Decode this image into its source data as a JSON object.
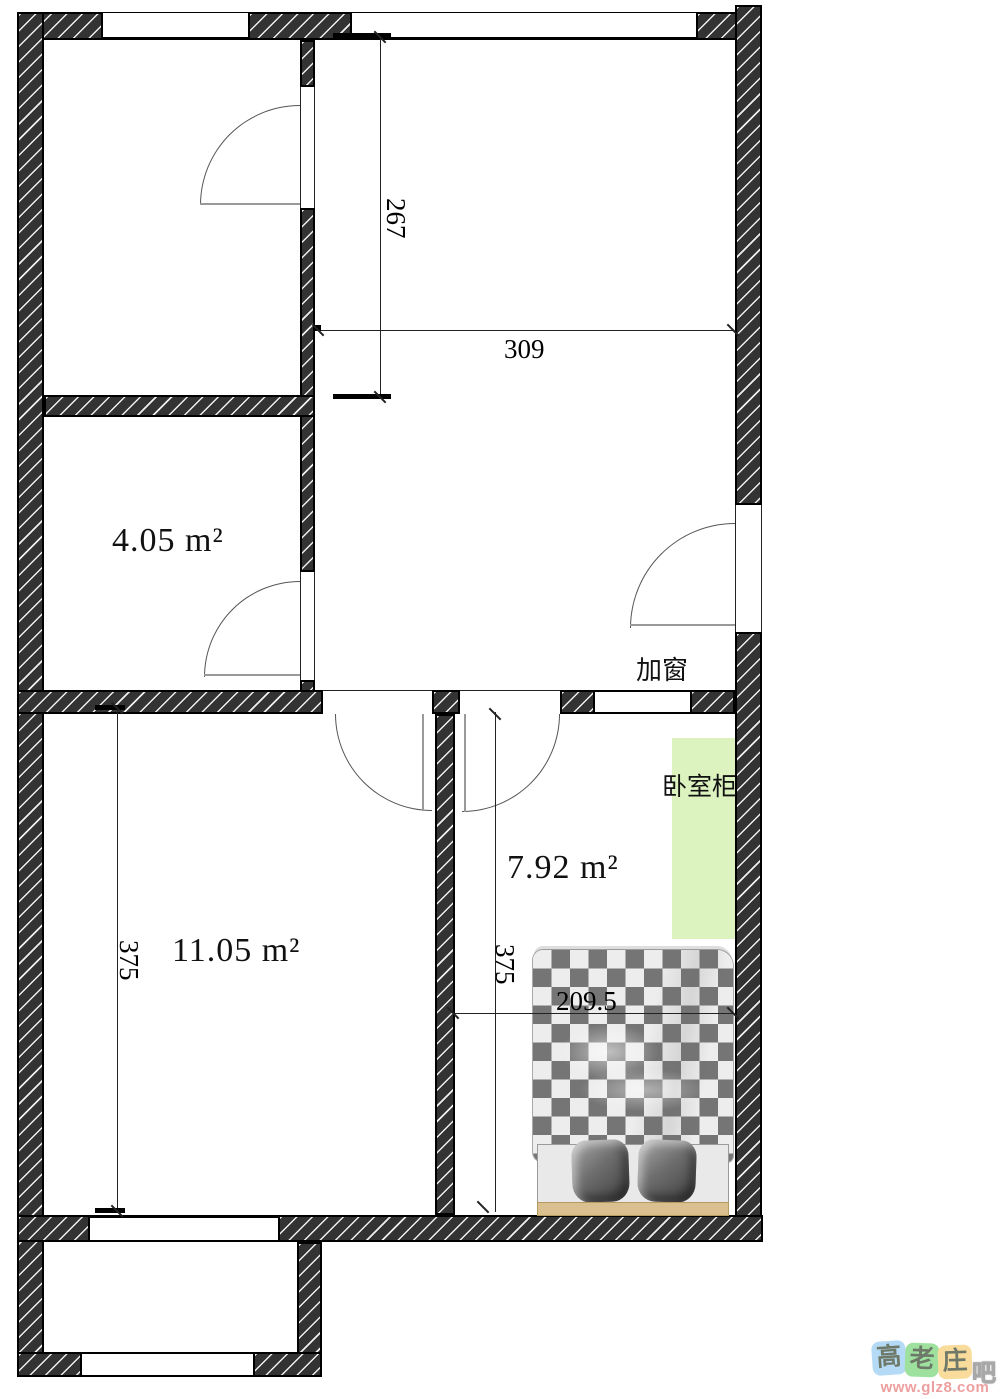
{
  "rooms": {
    "small": {
      "area": "4.05 m²"
    },
    "large": {
      "area": "11.05 m²"
    },
    "bedroom": {
      "area": "7.92 m²"
    }
  },
  "annotations": {
    "add_window": "加窗",
    "bedroom_cabinet": "卧室柜"
  },
  "dimensions": {
    "room_height": "267",
    "room_width": "309",
    "left_height": "375",
    "bedroom_height": "375",
    "bed_width": "209.5"
  },
  "watermark": {
    "tiles": [
      {
        "char": "高"
      },
      {
        "char": "老"
      },
      {
        "char": "庄"
      }
    ],
    "suffix": "吧",
    "url": "www.glz8.com"
  },
  "colors": {
    "wall_fill": "#333333",
    "wall_hatch": "#ffffff",
    "cabinet_green": "#dcf2bf",
    "bed_checker_dark": "#757575",
    "bed_checker_light": "#ededed",
    "bed_headboard": "#d9c08e",
    "pillow_gray": "#6e6e6e",
    "watermark_blue": "#a9d4f4",
    "watermark_green": "#8edc8e",
    "watermark_yellow": "#f8d68a",
    "watermark_url_color": "#ea8f8f"
  }
}
